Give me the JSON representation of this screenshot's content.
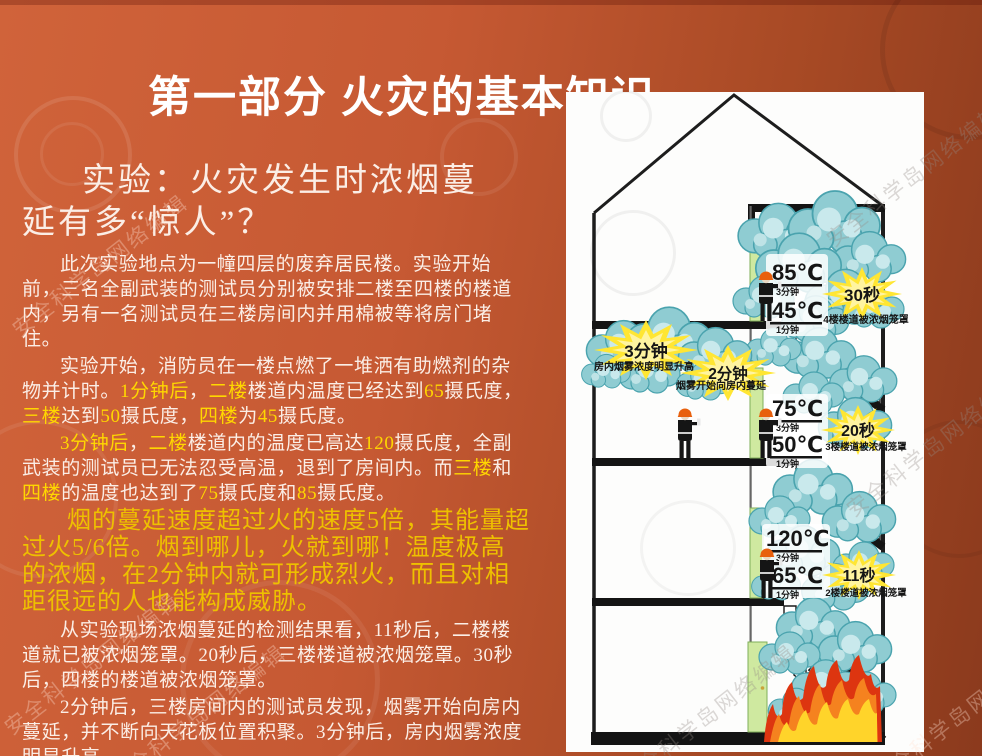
{
  "slide": {
    "title": "第一部分 火灾的基本知识",
    "watermark_text": "安全科学岛网络编辑"
  },
  "colors": {
    "text_white": "#fbeee6",
    "text_yellow": "#ffd700",
    "para_gold": "#eec000",
    "bg_left": "#d0633a",
    "bg_right": "#8b3a1d",
    "smoke_light": "#c9e9ec",
    "smoke_mid": "#8fccd2",
    "smoke_edge": "#4aa3ae",
    "burst_yellow": "#ffe633",
    "door_green": "#cfe9a0",
    "flame_red": "#dd3510",
    "flame_orange": "#f5821f",
    "flame_yellow": "#ffd42a"
  },
  "article": {
    "heading": "实验：火灾发生时浓烟蔓延有多“惊人”？",
    "paragraphs": [
      {
        "size": "normal",
        "segments": [
          {
            "c": "w",
            "t": "此次实验地点为一幢四层的废弃居民楼。实验开始前，三名全副武装的测试员分别被安排二楼至四楼的楼道内，另有一名测试员在三楼房间内并用棉被等将房门堵住。"
          }
        ]
      },
      {
        "size": "normal",
        "segments": [
          {
            "c": "w",
            "t": "实验开始，消防员在一楼点燃了一堆洒有助燃剂的杂物并计时。"
          },
          {
            "c": "y",
            "t": "1分钟后"
          },
          {
            "c": "w",
            "t": "，"
          },
          {
            "c": "y",
            "t": "二楼"
          },
          {
            "c": "w",
            "t": "楼道内温度已经达到"
          },
          {
            "c": "y",
            "t": "65"
          },
          {
            "c": "w",
            "t": "摄氏度，"
          },
          {
            "c": "y",
            "t": "三楼"
          },
          {
            "c": "w",
            "t": "达到"
          },
          {
            "c": "y",
            "t": "50"
          },
          {
            "c": "w",
            "t": "摄氏度，"
          },
          {
            "c": "y",
            "t": "四楼"
          },
          {
            "c": "w",
            "t": "为"
          },
          {
            "c": "y",
            "t": "45"
          },
          {
            "c": "w",
            "t": "摄氏度。"
          }
        ]
      },
      {
        "size": "normal",
        "segments": [
          {
            "c": "y",
            "t": "3分钟后"
          },
          {
            "c": "w",
            "t": "，"
          },
          {
            "c": "y",
            "t": "二楼"
          },
          {
            "c": "w",
            "t": "楼道内的温度已高达"
          },
          {
            "c": "y",
            "t": "120"
          },
          {
            "c": "w",
            "t": "摄氏度，全副武装的测试员已无法忍受高温，退到了房间内。而"
          },
          {
            "c": "y",
            "t": "三楼"
          },
          {
            "c": "w",
            "t": "和"
          },
          {
            "c": "y",
            "t": "四楼"
          },
          {
            "c": "w",
            "t": "的温度也达到了"
          },
          {
            "c": "y",
            "t": "75"
          },
          {
            "c": "w",
            "t": "摄氏度和"
          },
          {
            "c": "y",
            "t": "85"
          },
          {
            "c": "w",
            "t": "摄氏度。"
          }
        ]
      },
      {
        "size": "big",
        "segments": [
          {
            "c": "g",
            "t": "烟的蔓延速度超过火的速度5倍，其能量超过火5/6倍。烟到哪儿，火就到哪！温度极高的浓烟，在2分钟内就可形成烈火，而且对相距很远的人也能构成威胁。"
          }
        ]
      },
      {
        "size": "normal",
        "segments": [
          {
            "c": "w",
            "t": "从实验现场浓烟蔓延的检测结果看，11秒后，二楼楼道就已被浓烟笼罩。20秒后，三楼楼道被浓烟笼罩。30秒后，四楼的楼道被浓烟笼罩。"
          }
        ]
      },
      {
        "size": "normal",
        "segments": [
          {
            "c": "w",
            "t": "2分钟后，三楼房间内的测试员发现，烟雾开始向房内蔓延，并不断向天花板位置积聚。3分钟后，房内烟雾浓度明显升高……"
          }
        ]
      }
    ]
  },
  "diagram": {
    "floor4": {
      "temp_high": "85℃",
      "time_high": "3分钟",
      "temp_low": "45℃",
      "time_low": "1分钟",
      "burst": "30秒",
      "caption": "4楼楼道被浓烟笼罩"
    },
    "floor3": {
      "temp_high": "75℃",
      "time_high": "3分钟",
      "temp_low": "50℃",
      "time_low": "1分钟",
      "burst": "20秒",
      "caption": "3楼楼道被浓烟笼罩"
    },
    "floor2": {
      "temp_high": "120℃",
      "time_high": "3分钟",
      "temp_low": "65℃",
      "time_low": "1分钟",
      "burst": "11秒",
      "caption": "2楼楼道被浓烟笼罩"
    },
    "room3": {
      "burst_a": "3分钟",
      "caption_a": "房内烟雾浓度明显升高",
      "burst_b": "2分钟",
      "caption_b": "烟雾开始向房内蔓延"
    }
  }
}
